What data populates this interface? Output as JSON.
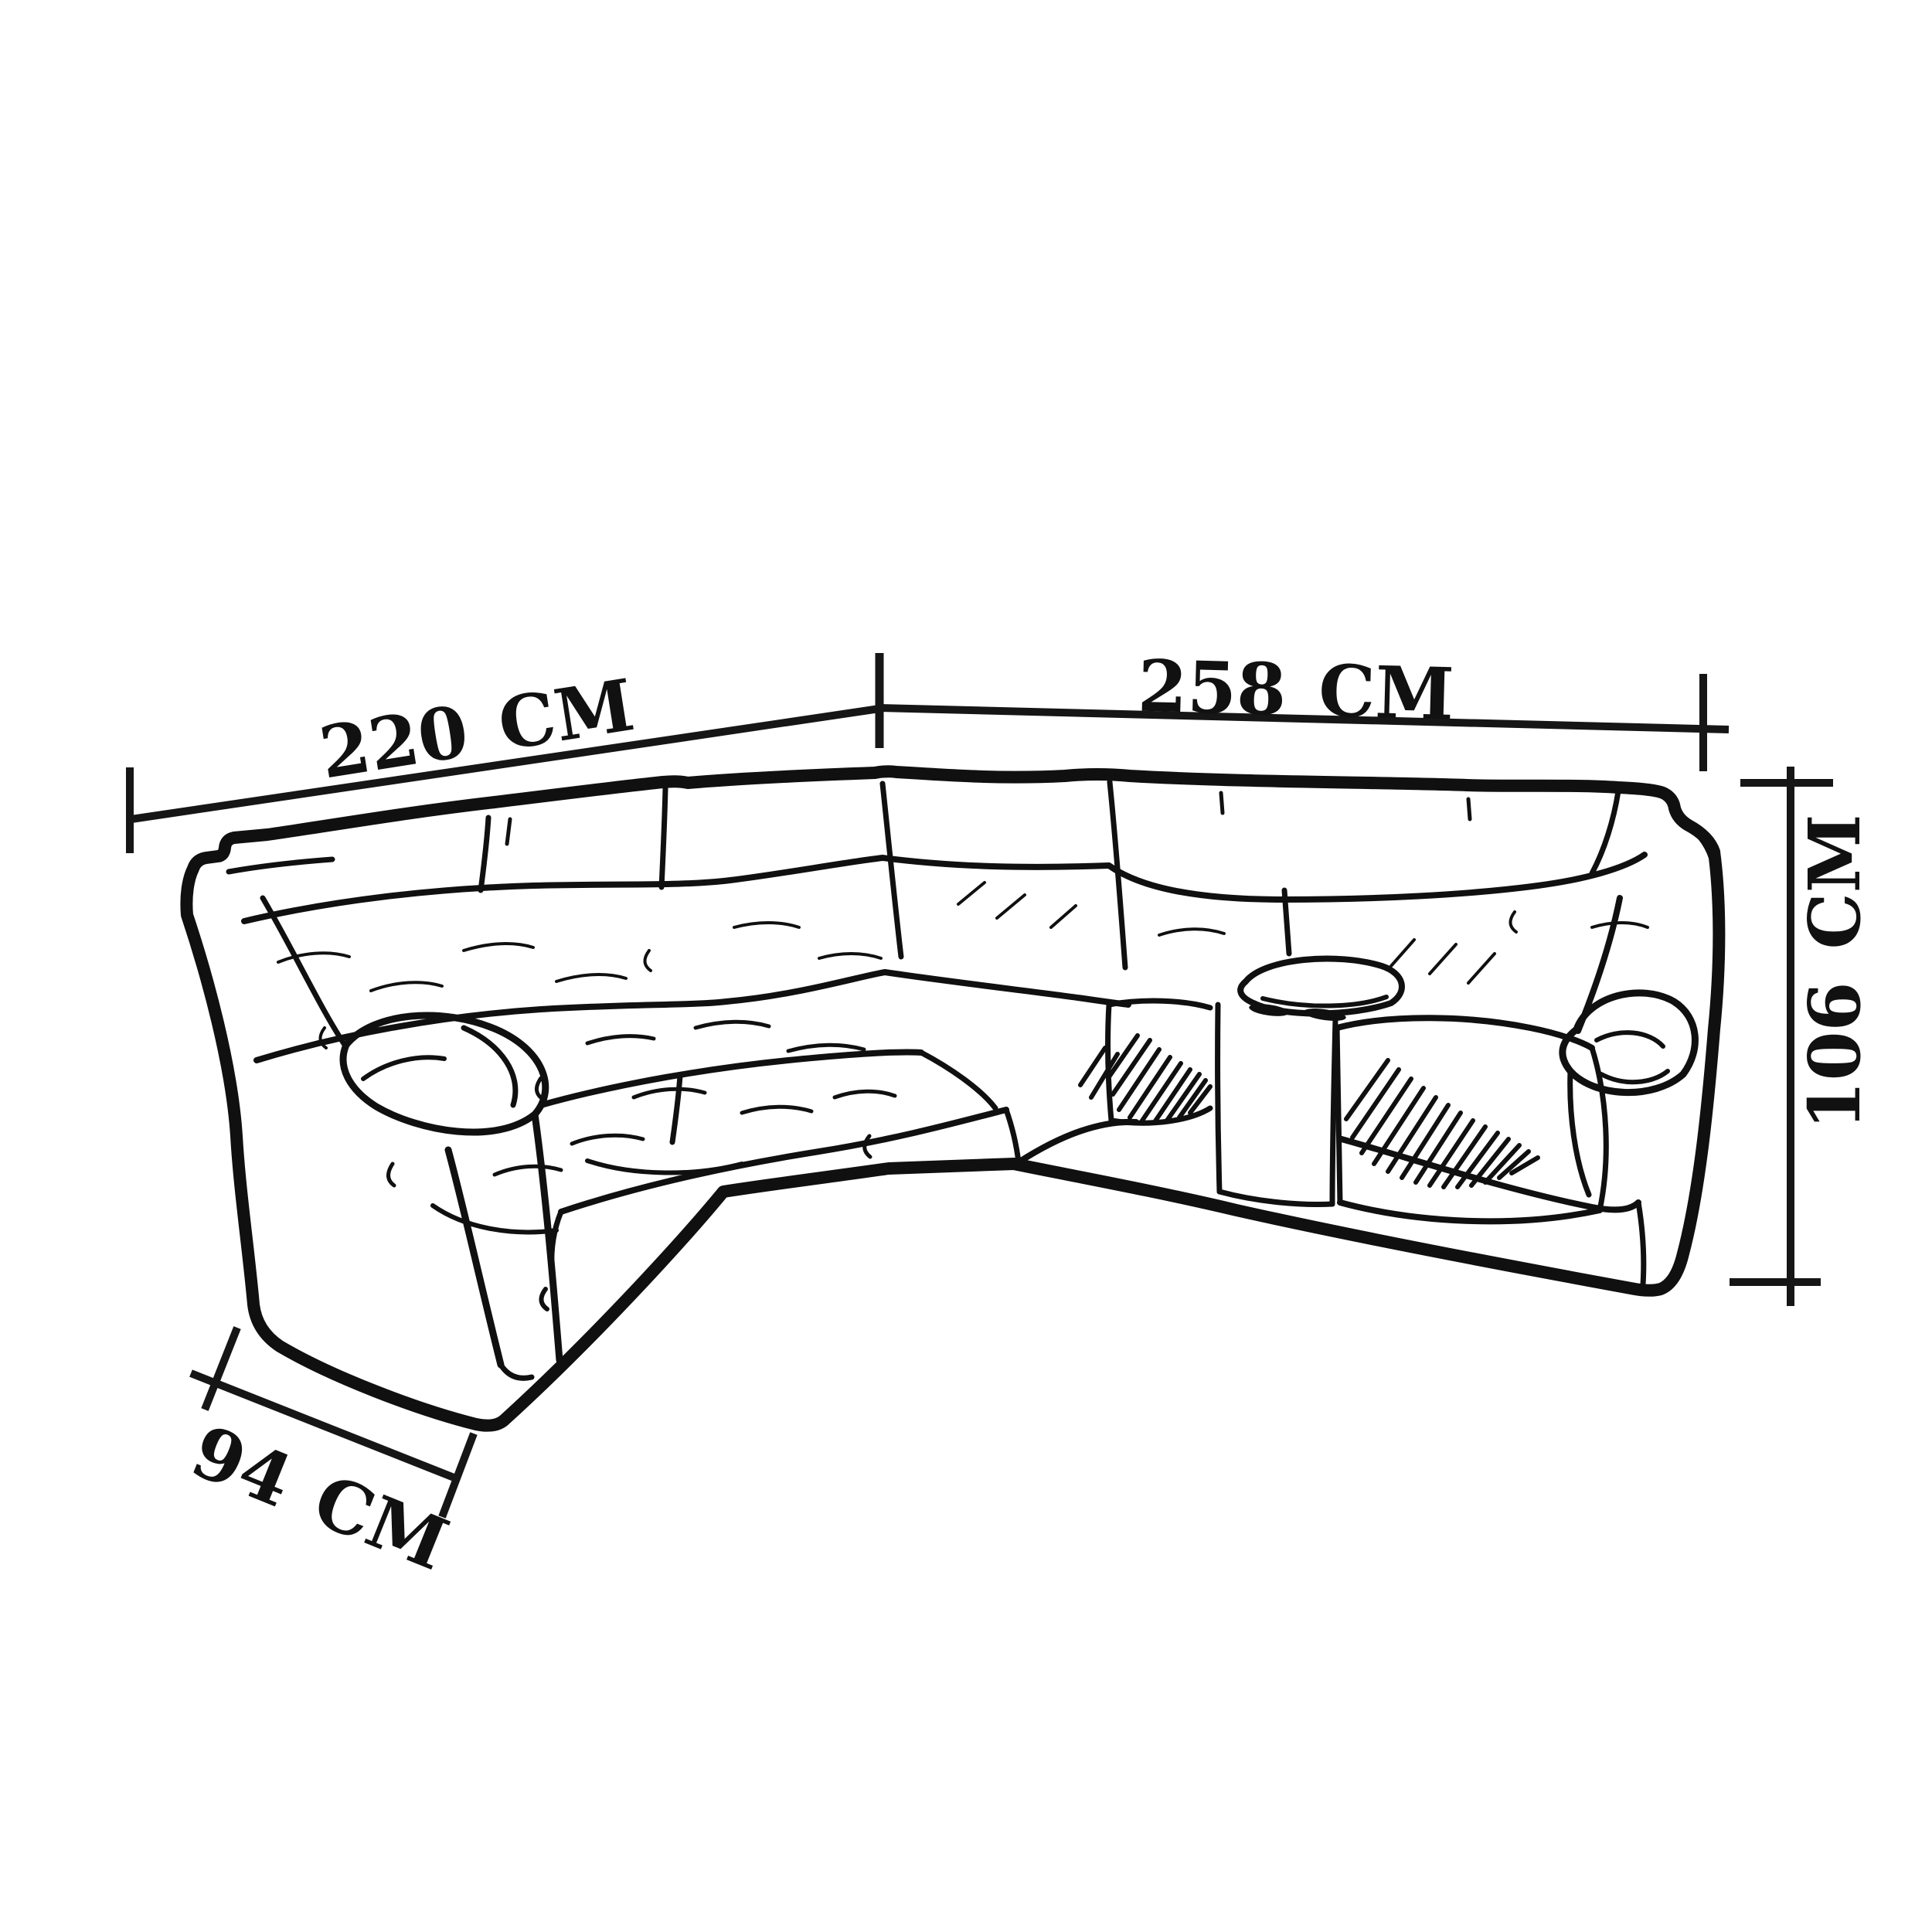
{
  "page": {
    "type": "product-dimension-sketch",
    "background_color": "#ffffff",
    "ink_color": "#101010"
  },
  "drawing": {
    "subject": "corner sectional recliner sofa",
    "style": "hand-drawn black ink line sketch with hatching",
    "features": [
      "left section with rolled armrest",
      "corner wedge seat",
      "right section with storage console",
      "two cup holders",
      "right rolled armrest",
      "hatched seat cushions"
    ]
  },
  "dimensions": {
    "left_section_width": {
      "value": "220",
      "unit": "CM",
      "label": "220 CM"
    },
    "right_section_width": {
      "value": "258",
      "unit": "CM",
      "label": "258 CM"
    },
    "back_height": {
      "value": "106",
      "unit": "CM",
      "label": "106 CM"
    },
    "seat_depth": {
      "value": "94",
      "unit": "CM",
      "label": "94 CM"
    }
  }
}
